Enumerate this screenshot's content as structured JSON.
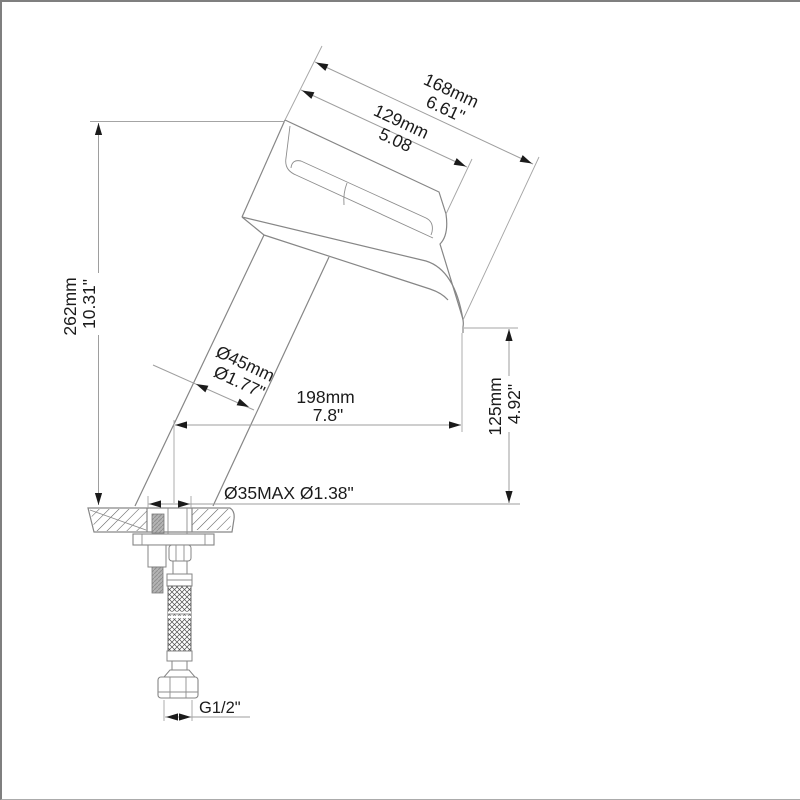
{
  "drawing": {
    "kind": "faucet-dimension-diagram",
    "dimensions": {
      "overall_height": {
        "metric": "262mm",
        "imperial": "10.31\""
      },
      "spout_outer_length": {
        "metric": "168mm",
        "imperial": "6.61\""
      },
      "spout_inner_length": {
        "metric": "129mm",
        "imperial": "5.08"
      },
      "body_diameter": {
        "metric": "Ø45mm",
        "imperial": "Ø1.77\""
      },
      "spout_reach": {
        "metric": "198mm",
        "imperial": "7.8\""
      },
      "spout_tip_height": {
        "metric": "125mm",
        "imperial": "4.92\""
      },
      "mounting_hole": {
        "label": "Ø35MAX Ø1.38\""
      },
      "thread": {
        "label": "G1/2\""
      }
    },
    "colors": {
      "object_line": "#868686",
      "dimension_line": "#9e9e9e",
      "text": "#1b1b1b",
      "arrow": "#1b1b1b",
      "hatch": "#5f5f5f",
      "border": "#7f7f7f",
      "background": "#ffffff"
    }
  }
}
